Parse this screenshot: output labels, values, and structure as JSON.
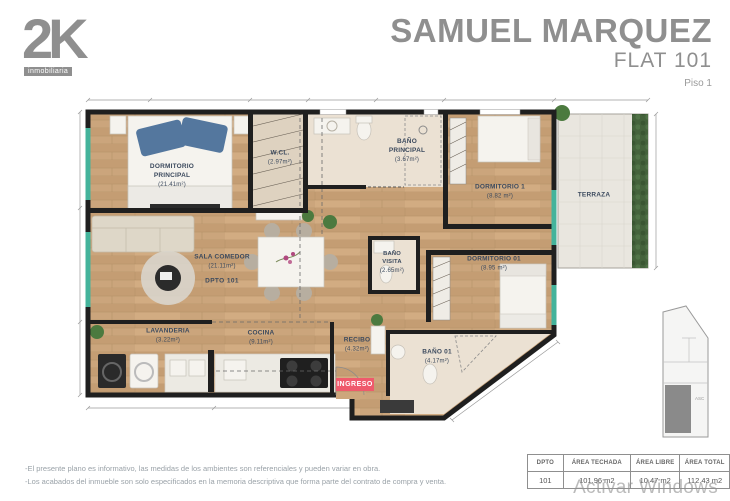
{
  "header": {
    "logo_text": "2K",
    "logo_subtext": "inmobiliaria",
    "title": "SAMUEL MARQUEZ",
    "subtitle": "FLAT 101",
    "floor": "Piso 1"
  },
  "plan": {
    "rooms": [
      {
        "name": "DORMITORIO PRINCIPAL",
        "area": "(21.41m²)"
      },
      {
        "name": "W.CL.",
        "area": "(2.97m²)"
      },
      {
        "name": "BAÑO PRINCIPAL",
        "area": "(3.67m²)"
      },
      {
        "name": "DORMITORIO 1",
        "area": "(8.82 m²)"
      },
      {
        "name": "TERRAZA",
        "area": ""
      },
      {
        "name": "SALA COMEDOR",
        "area": "(21.11m²)",
        "dpto": "DPTO 101"
      },
      {
        "name": "BAÑO VISITA",
        "area": "(2.65m²)"
      },
      {
        "name": "DORMITORIO 01",
        "area": "(8.95 m²)"
      },
      {
        "name": "LAVANDERIA",
        "area": "(3.22m²)"
      },
      {
        "name": "COCINA",
        "area": "(9.11m²)"
      },
      {
        "name": "RECIBO",
        "area": "(4.32m²)"
      },
      {
        "name": "BAÑO 01",
        "area": "(4.17m²)"
      }
    ],
    "entrance_label": "INGRESO",
    "keyplan_label": "ASC"
  },
  "footnotes": {
    "line1": "-El presente plano es informativo, las medidas de los ambientes son referenciales y pueden variar en obra.",
    "line2": "-Los acabados del inmueble son solo especificados en la memoria descriptiva que forma parte del contrato de compra y venta."
  },
  "table": {
    "headers": [
      "DPTO",
      "ÁREA TECHADA",
      "ÁREA LIBRE",
      "ÁREA TOTAL"
    ],
    "row": [
      "101",
      "101.96 m2",
      "10.47 m2",
      "112.43 m2"
    ]
  },
  "watermark": "Activar Windows",
  "colors": {
    "wall": "#1f1f1f",
    "window": "#44b39b",
    "badge": "#ef5a6c",
    "brand_gray": "#8f8f8f",
    "label_text": "#3c4a5e",
    "wood": "#cba57c",
    "bath_floor": "#ebe1d3",
    "terrace_floor": "#e9e6df",
    "hedge": "#45633c"
  }
}
